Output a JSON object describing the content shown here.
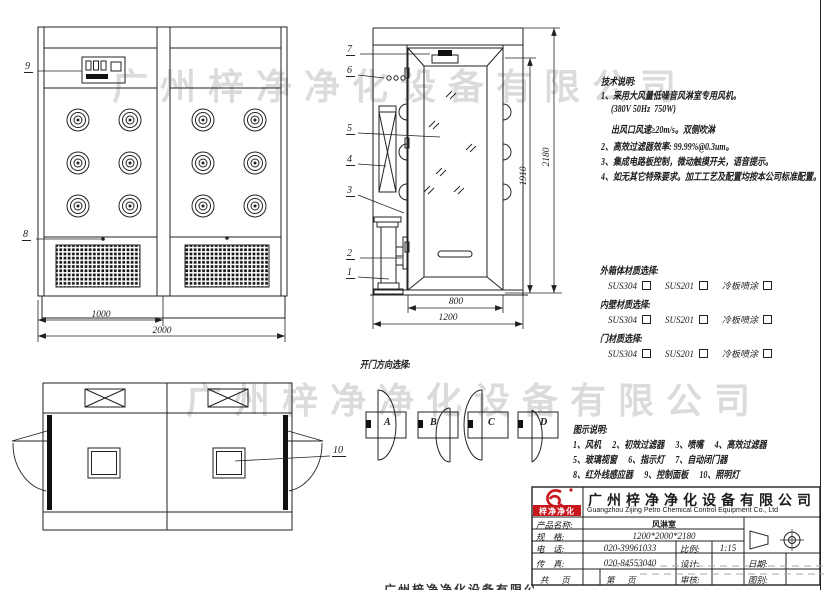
{
  "watermark": {
    "text": "广州梓净净化设备有限公司"
  },
  "callouts": {
    "n1": "1",
    "n2": "2",
    "n3": "3",
    "n4": "4",
    "n5": "5",
    "n6": "6",
    "n7": "7",
    "n8": "8",
    "n9": "9",
    "n10": "10"
  },
  "dims": {
    "front_half": "1000",
    "front_full": "2000",
    "side_door": "800",
    "side_depth": "1200",
    "side_inner_h": "1910",
    "side_total_h": "2180"
  },
  "door_direction": {
    "title": "开门方向选择:",
    "options": [
      "A",
      "B",
      "C",
      "D"
    ]
  },
  "tech_notes": {
    "title": "技术说明:",
    "l1": "1、采用大风量低噪音风淋室专用风机。",
    "l2": "(380V 50Hz  750W)",
    "l3": "出风口风速≥20m/s。双侧吹淋",
    "l4": "2、高效过滤器效率: 99.99%@0.3um。",
    "l5": "3、集成电路板控制，微动触摸开关，语音提示。",
    "l6": "4、如无其它特殊要求。加工工艺及配置均按本公司标准配置。"
  },
  "materials": {
    "g1": "外箱体材质选择:",
    "g2": "内壁材质选择:",
    "g3": "门材质选择:",
    "opt1": "SUS304",
    "opt2": "SUS201",
    "opt3": "冷板喷涂"
  },
  "legend": {
    "title": "图示说明:",
    "r1": [
      "1、风机",
      "2、初效过滤器",
      "3、喷嘴",
      "4、高效过滤器"
    ],
    "r2": [
      "5、玻璃视窗",
      "6、指示灯",
      "7、自动闭门器"
    ],
    "r3": [
      "8、红外线感应器",
      "9、控制面板",
      "10、照明灯"
    ]
  },
  "title_block": {
    "logo_text": "梓净净化",
    "company_cn": "广州梓净净化设备有限公司",
    "company_en": "Guangzhou Zijing Petro Chemical Control Equipment Co., Ltd",
    "product_label": "产品名称:",
    "product_value": "风淋室",
    "spec_label": "规    格:",
    "spec_value": "1200*2000*2180",
    "tel_label": "电    话:",
    "tel_value": "020-39961033",
    "scale_label": "比例:",
    "scale_value": "1:15",
    "fax_label": "传    真:",
    "fax_value": "020-84553040",
    "design_label": "设计:",
    "date_label": "日期:",
    "audit_label": "审核:",
    "type_label": "图别:",
    "pages_a": "共      页",
    "pages_b": "第      页"
  },
  "footer": {
    "clipped_text": "广州梓净净化设备有限公司"
  },
  "colors": {
    "line": "#222222",
    "logo_red": "#c8161d",
    "watermark_gray": "rgba(0,0,0,0.14)"
  }
}
